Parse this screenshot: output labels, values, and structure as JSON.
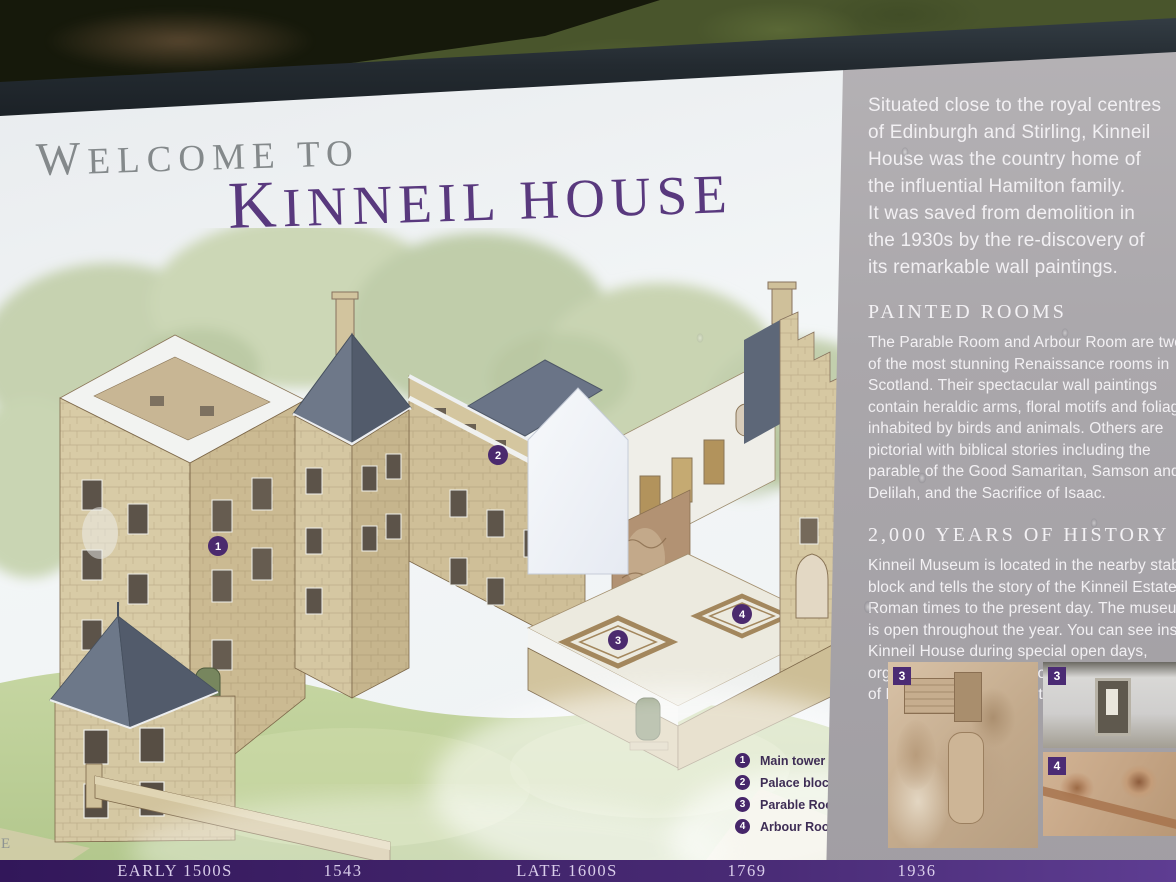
{
  "title": {
    "welcome": "WELCOME TO",
    "house": "KINNEIL HOUSE"
  },
  "edge_letter": "E",
  "sidebar": {
    "intro": "Situated close to the royal centres\nof Edinburgh and Stirling, Kinneil\nHouse was the country home of\nthe influential Hamilton family.\nIt was saved from demolition in\nthe 1930s by the re-discovery of\nits remarkable wall paintings.",
    "sections": [
      {
        "heading": "PAINTED ROOMS",
        "body": "The Parable Room and Arbour Room are two\nof the most stunning Renaissance rooms in\nScotland. Their spectacular wall paintings\ncontain heraldic arms, floral motifs and foliage\ninhabited by birds and animals. Others are\npictorial with biblical stories including the\nparable of the Good Samaritan, Samson and\nDelilah, and the Sacrifice of Isaac."
      },
      {
        "heading": "2,000 YEARS OF HISTORY",
        "body": "Kinneil Museum is located in the nearby stable-\nblock and tells the story of the Kinneil Estate from\nRoman times to the present day. The museum\nis open throughout the year. You can see inside\nKinneil House during special open days,\norganised by Historic Scotland and The Friends\nof Kinneil charity. Ask at the museum for details."
      }
    ],
    "photos": [
      {
        "badge": "3",
        "caption_name": "parable-room-wall-painting"
      },
      {
        "badge": "3",
        "caption_name": "parable-room-interior"
      },
      {
        "badge": "4",
        "caption_name": "arbour-room-ceiling-painting"
      }
    ]
  },
  "legend": {
    "items": [
      {
        "num": "1",
        "label": "Main tower"
      },
      {
        "num": "2",
        "label": "Palace block"
      },
      {
        "num": "3",
        "label": "Parable Room"
      },
      {
        "num": "4",
        "label": "Arbour Room"
      }
    ]
  },
  "markers": {
    "m1": "1",
    "m2": "2",
    "m3": "3",
    "m4": "4"
  },
  "timeline": [
    "EARLY 1500S",
    "1543",
    "LATE 1600S",
    "1769",
    "1936"
  ],
  "colors": {
    "accent_purple": "#59397e",
    "timeline_purple": "#3d2066",
    "legend_purple": "#46266a",
    "sidebar_gray": "#aaa7ab",
    "frame_dark": "#232a30"
  }
}
